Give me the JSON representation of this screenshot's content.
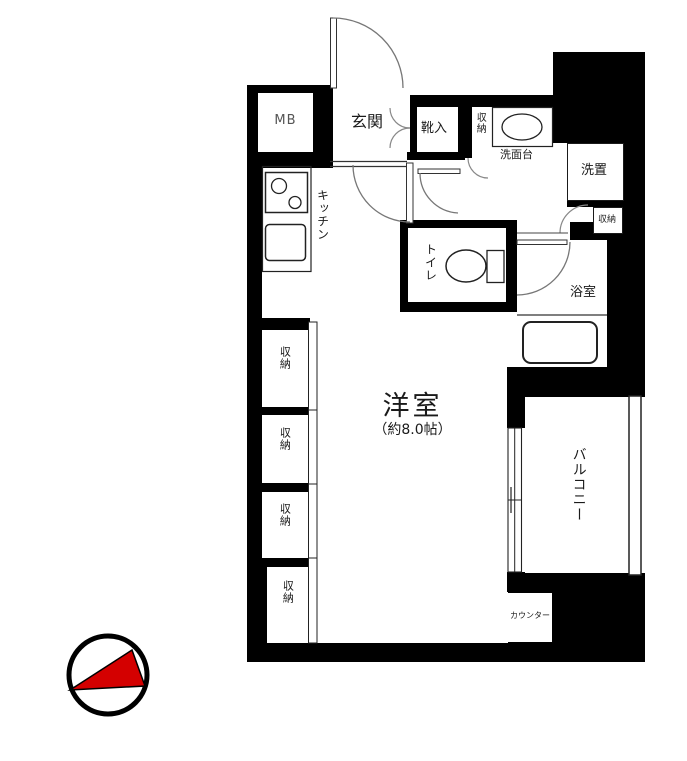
{
  "plan": {
    "mb": "MB",
    "genkan": "玄関",
    "kutsuiri": "靴入",
    "shuno_hall": "収納",
    "senmendai": "洗面台",
    "sentakuki": "洗置",
    "shuno_bath": "収納",
    "kitchen": "キッチン",
    "toilet": "トイレ",
    "bathroom": "浴室",
    "main_room": "洋室",
    "main_room_size": "（約8.0帖）",
    "balcony": "バルコニー",
    "counter": "カウンター",
    "closets": [
      "収納",
      "収納",
      "収納",
      "収納"
    ]
  },
  "colors": {
    "wall": "#000000",
    "compass_red": "#d40000",
    "line": "#333333"
  }
}
